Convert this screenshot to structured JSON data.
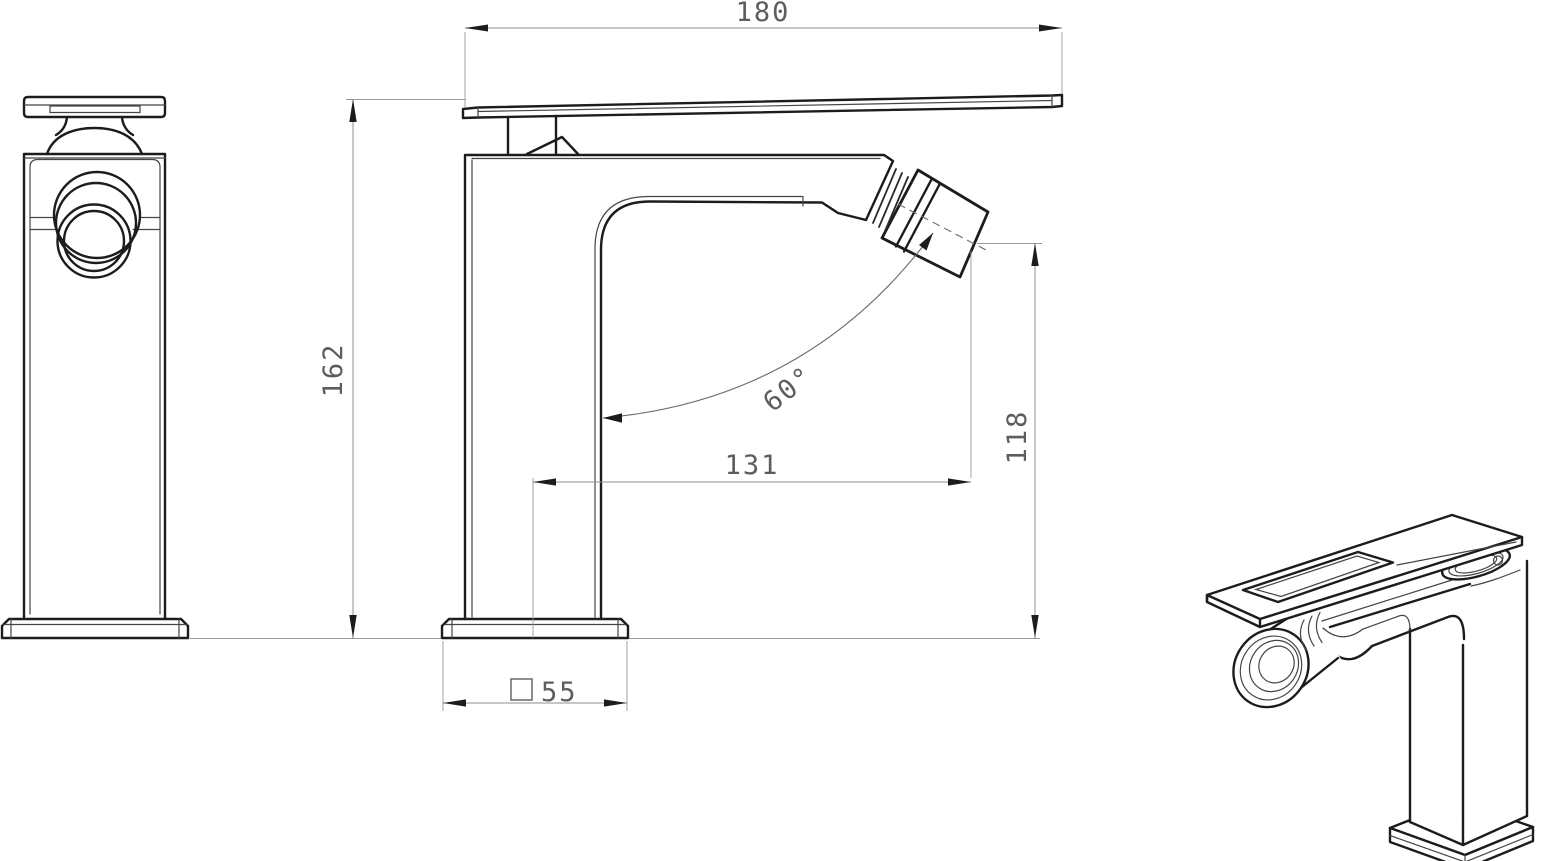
{
  "drawing": {
    "description": "technical drawing of single-lever bidet faucet, three views",
    "colors": {
      "background": "#ffffff",
      "outline": "#1c1c1c",
      "detail_line": "#454545",
      "dimension_line": "#8f8f8f",
      "dimension_text": "#5d5d5d"
    },
    "dimensions": {
      "overall_width": {
        "value": "180"
      },
      "overall_height": {
        "value": "162"
      },
      "spout_reach": {
        "value": "131"
      },
      "outlet_height": {
        "value": "118"
      },
      "aerator_angle": {
        "value": "60°"
      },
      "base_width": {
        "value": "55",
        "symbol": "square"
      }
    }
  }
}
